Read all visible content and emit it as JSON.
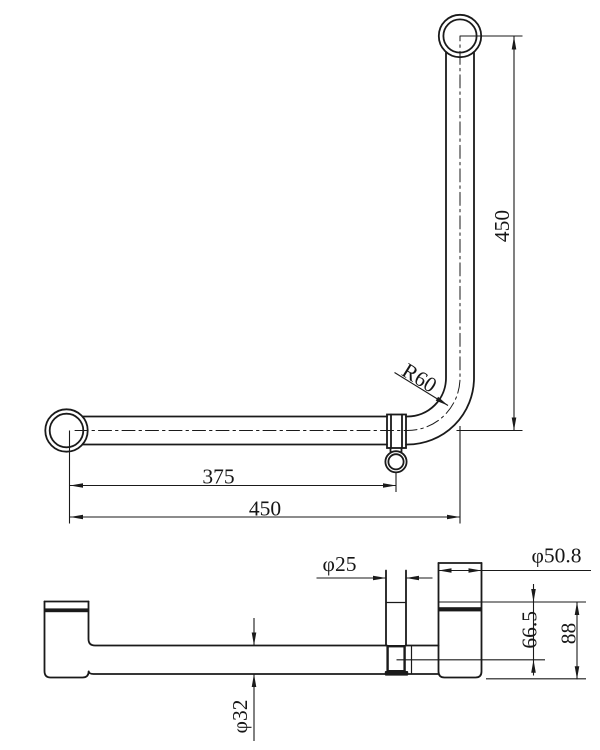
{
  "colors": {
    "line": "#1a1a1a",
    "background": "#ffffff"
  },
  "front_view": {
    "vertical_length": "450",
    "bracket_offset": "375",
    "horizontal_length": "450",
    "bend_radius": "R60"
  },
  "plan_view": {
    "post_diameter": "φ25",
    "flange_diameter": "φ50.8",
    "rail_diameter": "φ32",
    "wall_to_centerline": "66.5",
    "overall_projection": "88"
  }
}
